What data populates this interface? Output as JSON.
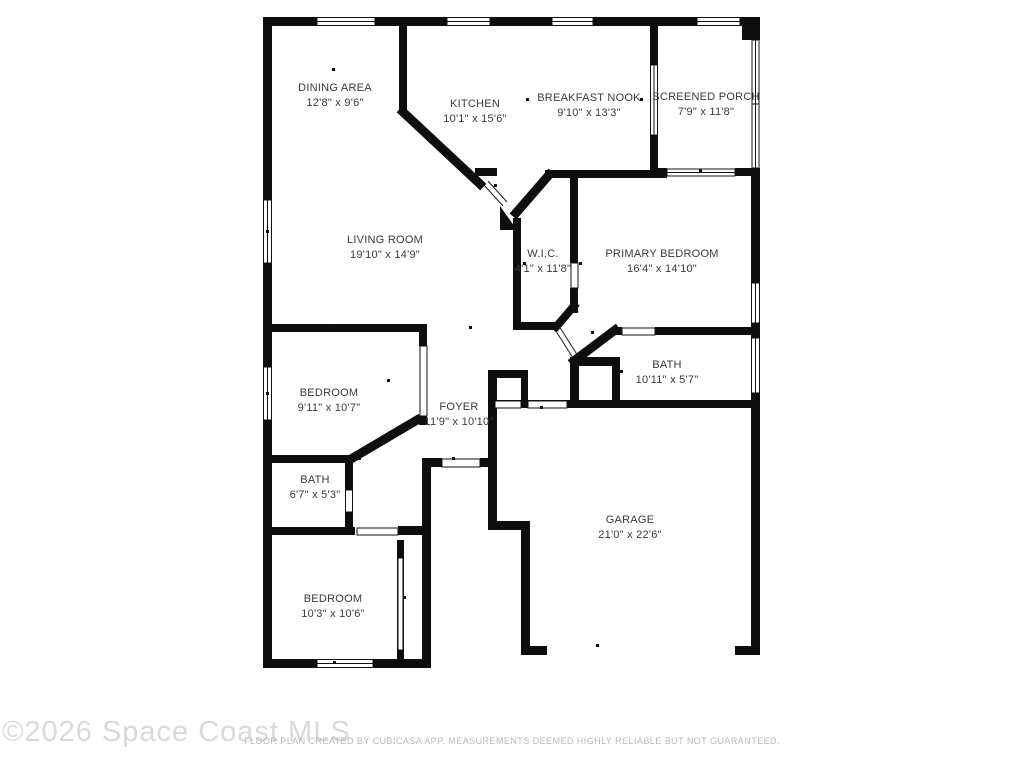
{
  "title": "Residential floor plan",
  "rooms": [
    {
      "id": "dining-area",
      "name": "DINING AREA",
      "dims": "12'8\" x 9'6\"",
      "x": 335,
      "y": 96
    },
    {
      "id": "kitchen",
      "name": "KITCHEN",
      "dims": "10'1\" x 15'6\"",
      "x": 475,
      "y": 112
    },
    {
      "id": "breakfast-nook",
      "name": "BREAKFAST NOOK",
      "dims": "9'10\" x 13'3\"",
      "x": 589,
      "y": 106
    },
    {
      "id": "screened-porch",
      "name": "SCREENED PORCH",
      "dims": "7'9\" x 11'8\"",
      "x": 706,
      "y": 105
    },
    {
      "id": "living-room",
      "name": "LIVING ROOM",
      "dims": "19'10\" x 14'9\"",
      "x": 385,
      "y": 248
    },
    {
      "id": "wic",
      "name": "W.I.C.",
      "dims": "4'1\" x 11'8\"",
      "x": 543,
      "y": 262
    },
    {
      "id": "primary-bedroom",
      "name": "PRIMARY BEDROOM",
      "dims": "16'4\" x 14'10\"",
      "x": 662,
      "y": 262
    },
    {
      "id": "bedroom-1",
      "name": "BEDROOM",
      "dims": "9'11\" x 10'7\"",
      "x": 329,
      "y": 401
    },
    {
      "id": "bath-primary",
      "name": "BATH",
      "dims": "10'11\" x 5'7\"",
      "x": 667,
      "y": 373
    },
    {
      "id": "foyer",
      "name": "FOYER",
      "dims": "11'9\" x 10'10\"",
      "x": 459,
      "y": 415
    },
    {
      "id": "bath-2",
      "name": "BATH",
      "dims": "6'7\" x 5'3\"",
      "x": 315,
      "y": 488
    },
    {
      "id": "bedroom-2",
      "name": "BEDROOM",
      "dims": "10'3\" x 10'6\"",
      "x": 333,
      "y": 607
    },
    {
      "id": "garage",
      "name": "GARAGE",
      "dims": "21'0\" x 22'6\"",
      "x": 630,
      "y": 528
    }
  ],
  "watermark": "©2026 Space Coast MLS",
  "footer": "FLOOR PLAN CREATED BY CUBICASA APP. MEASUREMENTS DEEMED HIGHLY RELIABLE BUT NOT GUARANTEED.",
  "colors": {
    "wall": "#0e0e0e",
    "label": "#3a3a3a",
    "watermark": "#d9d9d9",
    "footer": "#b9b9b9"
  }
}
